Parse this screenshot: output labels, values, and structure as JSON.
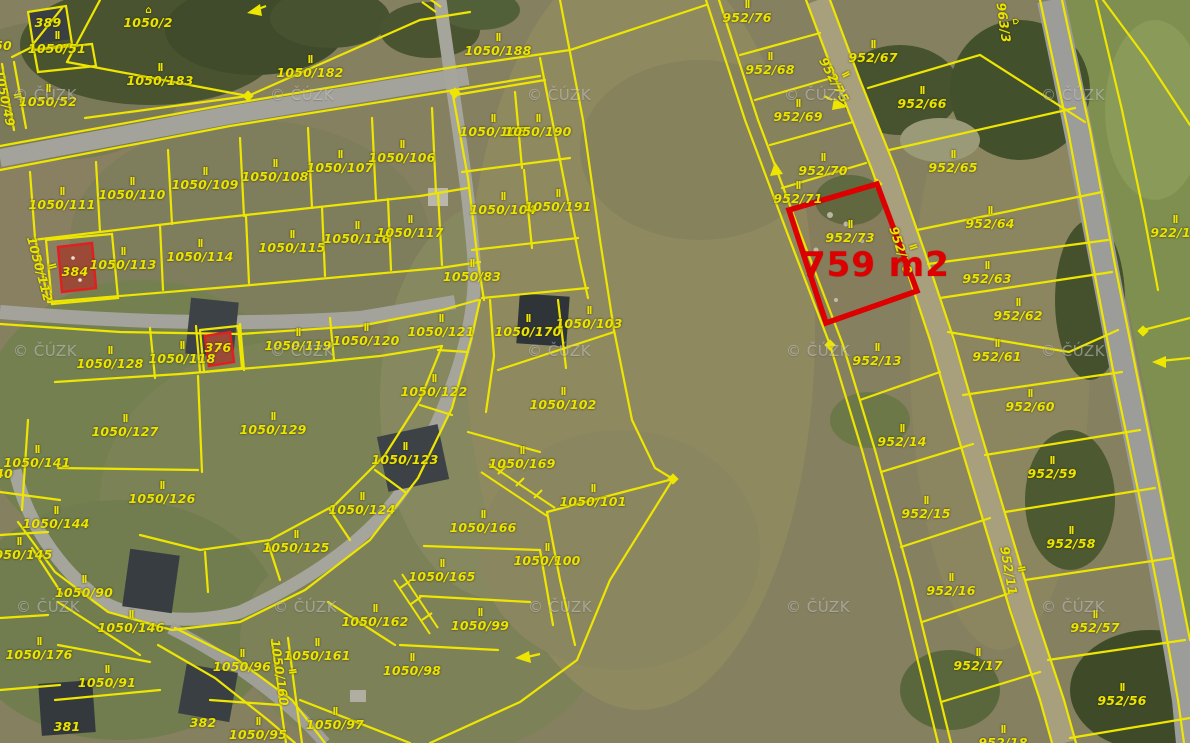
{
  "app": {
    "type": "cadastral-aerial-map"
  },
  "map": {
    "source_watermark": "© ČÚZK",
    "watermark_positions": [
      [
        45,
        95
      ],
      [
        302,
        95
      ],
      [
        559,
        95
      ],
      [
        816,
        95
      ],
      [
        1073,
        95
      ],
      [
        45,
        351
      ],
      [
        302,
        351
      ],
      [
        559,
        351
      ],
      [
        818,
        351
      ],
      [
        1073,
        351
      ],
      [
        48,
        607
      ],
      [
        305,
        607
      ],
      [
        560,
        607
      ],
      [
        818,
        607
      ],
      [
        1073,
        607
      ]
    ],
    "colors": {
      "parcel_line": "#eee600",
      "label": "#ece400",
      "highlight": "#dd0000",
      "road": "#a3a39b",
      "dirt_path": "#a89f7d",
      "field": "#85805f"
    },
    "highlight": {
      "parcel": "952/73",
      "area_text": "759 m2",
      "color": "#dd0000",
      "polygon": [
        [
          789,
          210
        ],
        [
          877,
          184
        ],
        [
          917,
          291
        ],
        [
          826,
          323
        ]
      ],
      "area_pos": [
        802,
        245
      ]
    },
    "labels": [
      {
        "text": "389",
        "x": 48,
        "y": 23,
        "rot": 0,
        "sym": 0
      },
      {
        "text": "1050/51",
        "x": 57,
        "y": 44,
        "rot": 0,
        "sym": 1
      },
      {
        "text": "50",
        "x": 3,
        "y": 46,
        "rot": 0,
        "sym": 0
      },
      {
        "text": "1050/49",
        "x": 9,
        "y": 97,
        "rot": 78,
        "sym": 1
      },
      {
        "text": "1050/52",
        "x": 48,
        "y": 97,
        "rot": 0,
        "sym": 1
      },
      {
        "text": "1050/2",
        "x": 148,
        "y": 18,
        "rot": 0,
        "sym": 2
      },
      {
        "text": "1050/183",
        "x": 160,
        "y": 76,
        "rot": 0,
        "sym": 1
      },
      {
        "text": "1050/182",
        "x": 310,
        "y": 68,
        "rot": 0,
        "sym": 1
      },
      {
        "text": "1050/111",
        "x": 62,
        "y": 200,
        "rot": 0,
        "sym": 1
      },
      {
        "text": "1050/110",
        "x": 132,
        "y": 190,
        "rot": 0,
        "sym": 1
      },
      {
        "text": "1050/109",
        "x": 205,
        "y": 180,
        "rot": 0,
        "sym": 1
      },
      {
        "text": "1050/108",
        "x": 275,
        "y": 172,
        "rot": 0,
        "sym": 1
      },
      {
        "text": "1050/107",
        "x": 340,
        "y": 163,
        "rot": 0,
        "sym": 1
      },
      {
        "text": "1050/106",
        "x": 402,
        "y": 153,
        "rot": 0,
        "sym": 1
      },
      {
        "text": "1050/113",
        "x": 123,
        "y": 260,
        "rot": 0,
        "sym": 1
      },
      {
        "text": "1050/114",
        "x": 200,
        "y": 252,
        "rot": 0,
        "sym": 1
      },
      {
        "text": "1050/115",
        "x": 292,
        "y": 243,
        "rot": 0,
        "sym": 1
      },
      {
        "text": "1050/116",
        "x": 357,
        "y": 234,
        "rot": 0,
        "sym": 1
      },
      {
        "text": "1050/117",
        "x": 410,
        "y": 228,
        "rot": 0,
        "sym": 1
      },
      {
        "text": "384",
        "x": 75,
        "y": 272,
        "rot": 0,
        "sym": 0
      },
      {
        "text": "1050/112",
        "x": 44,
        "y": 268,
        "rot": 75,
        "sym": 1
      },
      {
        "text": "1050/188",
        "x": 498,
        "y": 46,
        "rot": 0,
        "sym": 1
      },
      {
        "text": "1050/105",
        "x": 493,
        "y": 127,
        "rot": 0,
        "sym": 1
      },
      {
        "text": "1050/190",
        "x": 538,
        "y": 127,
        "rot": 0,
        "sym": 1
      },
      {
        "text": "1050/104",
        "x": 503,
        "y": 205,
        "rot": 0,
        "sym": 1
      },
      {
        "text": "1050/191",
        "x": 558,
        "y": 202,
        "rot": 0,
        "sym": 1
      },
      {
        "text": "1050/83",
        "x": 472,
        "y": 272,
        "rot": 0,
        "sym": 1
      },
      {
        "text": "1050/121",
        "x": 441,
        "y": 327,
        "rot": 0,
        "sym": 1
      },
      {
        "text": "1050/170",
        "x": 528,
        "y": 327,
        "rot": 0,
        "sym": 1
      },
      {
        "text": "1050/103",
        "x": 589,
        "y": 319,
        "rot": 0,
        "sym": 1
      },
      {
        "text": "1050/122",
        "x": 434,
        "y": 387,
        "rot": 0,
        "sym": 1
      },
      {
        "text": "1050/102",
        "x": 563,
        "y": 400,
        "rot": 0,
        "sym": 1
      },
      {
        "text": "1050/128",
        "x": 110,
        "y": 359,
        "rot": 0,
        "sym": 1
      },
      {
        "text": "1050/118",
        "x": 182,
        "y": 354,
        "rot": 0,
        "sym": 1
      },
      {
        "text": "376",
        "x": 218,
        "y": 348,
        "rot": 0,
        "sym": 0
      },
      {
        "text": "1050/119",
        "x": 298,
        "y": 341,
        "rot": 0,
        "sym": 1
      },
      {
        "text": "1050/120",
        "x": 366,
        "y": 336,
        "rot": 0,
        "sym": 1
      },
      {
        "text": "1050/127",
        "x": 125,
        "y": 427,
        "rot": 0,
        "sym": 1
      },
      {
        "text": "1050/129",
        "x": 273,
        "y": 425,
        "rot": 0,
        "sym": 1
      },
      {
        "text": "1050/141",
        "x": 37,
        "y": 458,
        "rot": 0,
        "sym": 1
      },
      {
        "text": "40",
        "x": 4,
        "y": 474,
        "rot": 0,
        "sym": 0
      },
      {
        "text": "1050/144",
        "x": 56,
        "y": 519,
        "rot": 0,
        "sym": 1
      },
      {
        "text": "1050/145",
        "x": 19,
        "y": 550,
        "rot": 0,
        "sym": 1
      },
      {
        "text": "1050/90",
        "x": 84,
        "y": 588,
        "rot": 0,
        "sym": 1
      },
      {
        "text": "1050/146",
        "x": 131,
        "y": 623,
        "rot": 0,
        "sym": 1
      },
      {
        "text": "1050/176",
        "x": 39,
        "y": 650,
        "rot": 0,
        "sym": 1
      },
      {
        "text": "1050/91",
        "x": 107,
        "y": 678,
        "rot": 0,
        "sym": 1
      },
      {
        "text": "1050/126",
        "x": 162,
        "y": 494,
        "rot": 0,
        "sym": 1
      },
      {
        "text": "1050/123",
        "x": 405,
        "y": 455,
        "rot": 0,
        "sym": 1
      },
      {
        "text": "1050/124",
        "x": 362,
        "y": 505,
        "rot": 0,
        "sym": 1
      },
      {
        "text": "1050/125",
        "x": 296,
        "y": 543,
        "rot": 0,
        "sym": 1
      },
      {
        "text": "1050/162",
        "x": 375,
        "y": 617,
        "rot": 0,
        "sym": 1
      },
      {
        "text": "1050/161",
        "x": 317,
        "y": 651,
        "rot": 0,
        "sym": 1
      },
      {
        "text": "1050/160",
        "x": 284,
        "y": 672,
        "rot": 82,
        "sym": 1
      },
      {
        "text": "1050/96",
        "x": 242,
        "y": 662,
        "rot": 0,
        "sym": 1
      },
      {
        "text": "1050/97",
        "x": 335,
        "y": 720,
        "rot": 0,
        "sym": 1
      },
      {
        "text": "1050/95",
        "x": 258,
        "y": 730,
        "rot": 0,
        "sym": 1
      },
      {
        "text": "381",
        "x": 67,
        "y": 727,
        "rot": 0,
        "sym": 0
      },
      {
        "text": "382",
        "x": 203,
        "y": 723,
        "rot": 0,
        "sym": 0
      },
      {
        "text": "1050/98",
        "x": 412,
        "y": 666,
        "rot": 0,
        "sym": 1
      },
      {
        "text": "1050/99",
        "x": 480,
        "y": 621,
        "rot": 0,
        "sym": 1
      },
      {
        "text": "1050/165",
        "x": 442,
        "y": 572,
        "rot": 0,
        "sym": 1
      },
      {
        "text": "1050/166",
        "x": 483,
        "y": 523,
        "rot": 0,
        "sym": 1
      },
      {
        "text": "1050/169",
        "x": 522,
        "y": 459,
        "rot": 0,
        "sym": 1
      },
      {
        "text": "1050/100",
        "x": 547,
        "y": 556,
        "rot": 0,
        "sym": 1
      },
      {
        "text": "1050/101",
        "x": 593,
        "y": 497,
        "rot": 0,
        "sym": 1
      },
      {
        "text": "952/76",
        "x": 747,
        "y": 13,
        "rot": 0,
        "sym": 1
      },
      {
        "text": "952/68",
        "x": 770,
        "y": 65,
        "rot": 0,
        "sym": 1
      },
      {
        "text": "952/69",
        "x": 798,
        "y": 112,
        "rot": 0,
        "sym": 1
      },
      {
        "text": "952/70",
        "x": 823,
        "y": 166,
        "rot": 0,
        "sym": 1
      },
      {
        "text": "952/71",
        "x": 798,
        "y": 194,
        "rot": 0,
        "sym": 1
      },
      {
        "text": "952/75",
        "x": 838,
        "y": 78,
        "rot": 62,
        "sym": 1
      },
      {
        "text": "952/73",
        "x": 850,
        "y": 233,
        "rot": 0,
        "sym": 1
      },
      {
        "text": "952/70",
        "x": 905,
        "y": 249,
        "rot": 72,
        "sym": 1
      },
      {
        "text": "963/3",
        "x": 1008,
        "y": 22,
        "rot": 82,
        "sym": 2
      },
      {
        "text": "952/67",
        "x": 873,
        "y": 53,
        "rot": 0,
        "sym": 1
      },
      {
        "text": "952/66",
        "x": 922,
        "y": 99,
        "rot": 0,
        "sym": 1
      },
      {
        "text": "952/65",
        "x": 953,
        "y": 163,
        "rot": 0,
        "sym": 1
      },
      {
        "text": "952/64",
        "x": 990,
        "y": 219,
        "rot": 0,
        "sym": 1
      },
      {
        "text": "952/63",
        "x": 987,
        "y": 274,
        "rot": 0,
        "sym": 1
      },
      {
        "text": "952/62",
        "x": 1018,
        "y": 311,
        "rot": 0,
        "sym": 1
      },
      {
        "text": "952/61",
        "x": 997,
        "y": 352,
        "rot": 0,
        "sym": 1
      },
      {
        "text": "952/60",
        "x": 1030,
        "y": 402,
        "rot": 0,
        "sym": 1
      },
      {
        "text": "952/59",
        "x": 1052,
        "y": 469,
        "rot": 0,
        "sym": 1
      },
      {
        "text": "952/58",
        "x": 1071,
        "y": 539,
        "rot": 0,
        "sym": 1
      },
      {
        "text": "952/57",
        "x": 1095,
        "y": 623,
        "rot": 0,
        "sym": 1
      },
      {
        "text": "952/56",
        "x": 1122,
        "y": 696,
        "rot": 0,
        "sym": 1
      },
      {
        "text": "952/13",
        "x": 877,
        "y": 356,
        "rot": 0,
        "sym": 1
      },
      {
        "text": "952/14",
        "x": 902,
        "y": 437,
        "rot": 0,
        "sym": 1
      },
      {
        "text": "952/15",
        "x": 926,
        "y": 509,
        "rot": 0,
        "sym": 1
      },
      {
        "text": "952/16",
        "x": 951,
        "y": 586,
        "rot": 0,
        "sym": 1
      },
      {
        "text": "952/17",
        "x": 978,
        "y": 661,
        "rot": 0,
        "sym": 1
      },
      {
        "text": "952/18",
        "x": 1003,
        "y": 738,
        "rot": 0,
        "sym": 1
      },
      {
        "text": "952/11",
        "x": 1013,
        "y": 570,
        "rot": 80,
        "sym": 1
      },
      {
        "text": "922/11",
        "x": 1175,
        "y": 228,
        "rot": 0,
        "sym": 1
      }
    ]
  }
}
